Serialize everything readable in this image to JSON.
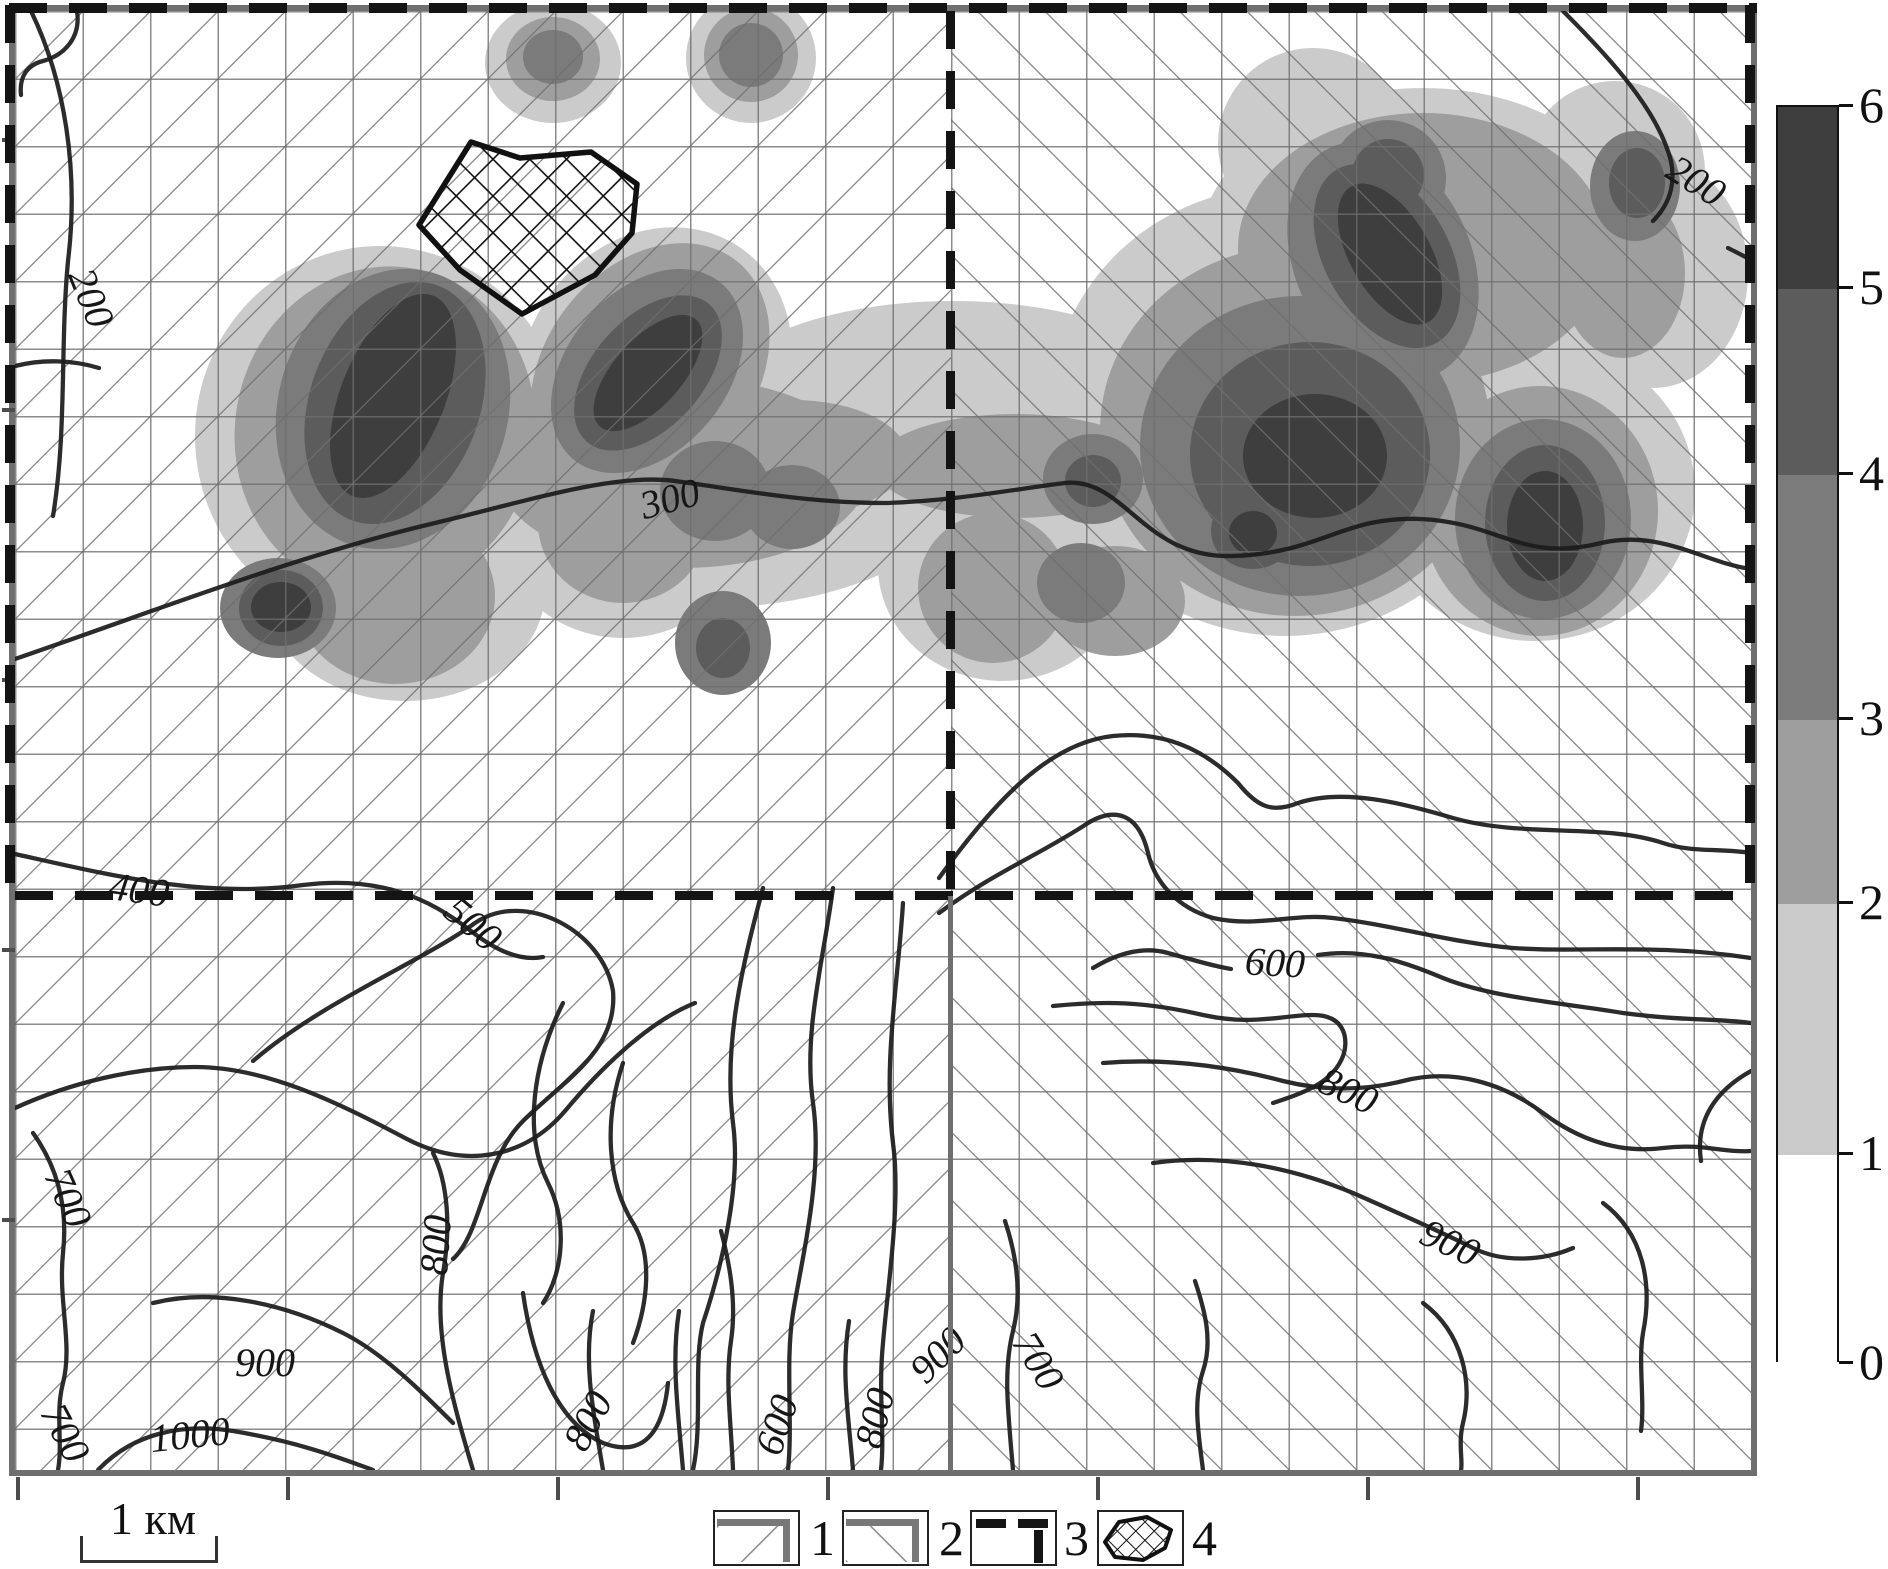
{
  "scalebar": {
    "label": "1 км"
  },
  "colorbar": {
    "labels": [
      "6",
      "5",
      "4",
      "3",
      "2",
      "1",
      "0"
    ],
    "boundaries_y": [
      105,
      287,
      473,
      718,
      902,
      1153,
      1362
    ],
    "segment_colors": [
      "#3e3e3e",
      "#5c5c5c",
      "#7b7b7b",
      "#9e9e9e",
      "#cbcbcb",
      "#ffffff"
    ],
    "x": 1776,
    "width": 63
  },
  "legend": {
    "items": [
      {
        "label": "1",
        "type": "hatch-forward"
      },
      {
        "label": "2",
        "type": "hatch-back"
      },
      {
        "label": "3",
        "type": "boundary-lines"
      },
      {
        "label": "4",
        "type": "crosshatch-polygon"
      }
    ],
    "box_xs": [
      713,
      842,
      970,
      1097
    ],
    "num_xs": [
      810,
      939,
      1064,
      1192
    ]
  },
  "map": {
    "x": 12,
    "y": 8,
    "width": 1736,
    "height": 1459,
    "grid_spacing": 67.5,
    "frame_color": "#6f6f6f",
    "dash_color": "#141414",
    "hatch_left_direction": "/",
    "hatch_right_direction": "\\",
    "divider_x": 936,
    "divider_y": 885,
    "bottom_ticks_x": [
      1,
      271,
      541,
      811,
      1081,
      1351,
      1621
    ],
    "left_ticks_y": [
      127,
      397,
      667,
      937,
      1207
    ]
  },
  "level_colors": {
    "1": "#cbcbcb",
    "2": "#9e9e9e",
    "3": "#7b7b7b",
    "4": "#5c5c5c",
    "5": "#3e3e3e"
  },
  "anomaly_blobs": [
    [
      365,
      425,
      185,
      190,
      0,
      1
    ],
    [
      640,
      360,
      130,
      150,
      35,
      1
    ],
    [
      688,
      472,
      260,
      125,
      0,
      1
    ],
    [
      938,
      400,
      250,
      110,
      0,
      1
    ],
    [
      988,
      555,
      125,
      115,
      0,
      1
    ],
    [
      1270,
      400,
      235,
      225,
      0,
      1
    ],
    [
      1408,
      242,
      225,
      165,
      0,
      1
    ],
    [
      1520,
      480,
      160,
      150,
      0,
      1
    ],
    [
      1638,
      262,
      95,
      115,
      0,
      1
    ],
    [
      1600,
      160,
      90,
      90,
      0,
      1
    ],
    [
      1298,
      132,
      95,
      95,
      0,
      1
    ],
    [
      538,
      52,
      68,
      60,
      0,
      1
    ],
    [
      736,
      47,
      65,
      65,
      0,
      1
    ],
    [
      608,
      512,
      125,
      115,
      0,
      1
    ],
    [
      390,
      580,
      140,
      110,
      0,
      1
    ],
    [
      370,
      420,
      150,
      165,
      10,
      2
    ],
    [
      635,
      360,
      105,
      140,
      38,
      2
    ],
    [
      668,
      462,
      185,
      95,
      0,
      2
    ],
    [
      778,
      447,
      115,
      58,
      0,
      2
    ],
    [
      1000,
      455,
      140,
      52,
      0,
      2
    ],
    [
      1280,
      420,
      195,
      185,
      0,
      2
    ],
    [
      1408,
      237,
      185,
      135,
      0,
      2
    ],
    [
      1525,
      500,
      118,
      125,
      0,
      2
    ],
    [
      1608,
      262,
      62,
      85,
      0,
      2
    ],
    [
      538,
      48,
      47,
      42,
      0,
      2
    ],
    [
      736,
      44,
      47,
      47,
      0,
      2
    ],
    [
      978,
      577,
      75,
      75,
      0,
      2
    ],
    [
      1100,
      590,
      70,
      55,
      0,
      2
    ],
    [
      608,
      512,
      85,
      80,
      0,
      2
    ],
    [
      380,
      585,
      100,
      88,
      0,
      2
    ],
    [
      378,
      398,
      115,
      142,
      16,
      3
    ],
    [
      632,
      360,
      80,
      115,
      40,
      3
    ],
    [
      700,
      480,
      55,
      50,
      0,
      3
    ],
    [
      777,
      496,
      48,
      42,
      0,
      3
    ],
    [
      1078,
      468,
      50,
      45,
      0,
      3
    ],
    [
      1066,
      572,
      44,
      40,
      0,
      3
    ],
    [
      1285,
      435,
      160,
      150,
      0,
      3
    ],
    [
      1368,
      250,
      88,
      125,
      -25,
      3
    ],
    [
      1528,
      508,
      88,
      100,
      0,
      3
    ],
    [
      1620,
      175,
      45,
      55,
      0,
      3
    ],
    [
      1373,
      167,
      58,
      58,
      0,
      3
    ],
    [
      538,
      46,
      30,
      27,
      0,
      3
    ],
    [
      736,
      44,
      32,
      32,
      0,
      3
    ],
    [
      708,
      632,
      48,
      52,
      0,
      3
    ],
    [
      263,
      597,
      58,
      50,
      0,
      3
    ],
    [
      1248,
      522,
      60,
      55,
      0,
      3
    ],
    [
      380,
      392,
      85,
      125,
      20,
      4
    ],
    [
      633,
      362,
      55,
      92,
      42,
      4
    ],
    [
      1295,
      443,
      120,
      112,
      0,
      4
    ],
    [
      1372,
      245,
      62,
      100,
      -30,
      4
    ],
    [
      1530,
      512,
      60,
      78,
      0,
      4
    ],
    [
      266,
      597,
      42,
      38,
      0,
      4
    ],
    [
      1373,
      164,
      36,
      36,
      0,
      4
    ],
    [
      708,
      637,
      27,
      30,
      0,
      4
    ],
    [
      1238,
      520,
      42,
      38,
      0,
      4
    ],
    [
      1078,
      470,
      28,
      26,
      0,
      4
    ],
    [
      1622,
      172,
      28,
      35,
      0,
      4
    ],
    [
      378,
      385,
      52,
      108,
      22,
      5
    ],
    [
      633,
      362,
      34,
      72,
      42,
      5
    ],
    [
      1300,
      445,
      72,
      62,
      0,
      5
    ],
    [
      1375,
      243,
      40,
      78,
      -30,
      5
    ],
    [
      266,
      596,
      30,
      25,
      0,
      5
    ],
    [
      1530,
      515,
      38,
      55,
      0,
      5
    ],
    [
      1238,
      522,
      24,
      22,
      0,
      5
    ]
  ],
  "crosshatch_polygon": {
    "points": "404,214 456,131 505,147 576,141 622,173 617,222 580,264 507,303 445,259"
  },
  "legend_polygon_points": "6,30 20,10 48,5 72,18 66,36 44,48 16,45",
  "contour_labels": [
    {
      "text": "200",
      "x": 76,
      "y": 287,
      "rot": 68
    },
    {
      "text": "200",
      "x": 1681,
      "y": 170,
      "rot": 32
    },
    {
      "text": "300",
      "x": 655,
      "y": 488,
      "rot": -15
    },
    {
      "text": "400",
      "x": 124,
      "y": 879,
      "rot": 8
    },
    {
      "text": "500",
      "x": 458,
      "y": 913,
      "rot": 40
    },
    {
      "text": "600",
      "x": 1260,
      "y": 952,
      "rot": 3
    },
    {
      "text": "800",
      "x": 1333,
      "y": 1080,
      "rot": 25
    },
    {
      "text": "900",
      "x": 1435,
      "y": 1232,
      "rot": 25
    },
    {
      "text": "700",
      "x": 53,
      "y": 1187,
      "rot": 66
    },
    {
      "text": "800",
      "x": 421,
      "y": 1234,
      "rot": -86
    },
    {
      "text": "900",
      "x": 250,
      "y": 1352,
      "rot": 0
    },
    {
      "text": "1000",
      "x": 175,
      "y": 1424,
      "rot": -6
    },
    {
      "text": "700",
      "x": 50,
      "y": 1422,
      "rot": 62
    },
    {
      "text": "800",
      "x": 573,
      "y": 1410,
      "rot": -62
    },
    {
      "text": "600",
      "x": 762,
      "y": 1414,
      "rot": -72
    },
    {
      "text": "800",
      "x": 860,
      "y": 1407,
      "rot": -76
    },
    {
      "text": "900",
      "x": 923,
      "y": 1344,
      "rot": -45
    },
    {
      "text": "700",
      "x": 1023,
      "y": 1350,
      "rot": 58
    }
  ],
  "contour_paths": [
    "M 16,0 C 50,70 64,160 53,250 C 45,335 52,420 38,505",
    "M 62,0 C 66,26 50,44 28,50 C 12,54 4,66 6,84",
    "M 0,355 C 28,348 58,349 84,357",
    "M 0,648 C 140,600 280,545 420,512 C 520,488 600,462 660,470 C 720,478 790,492 870,492 C 940,490 1000,478 1050,472 C 1110,466 1128,548 1218,545 C 1308,542 1326,505 1406,508 C 1486,512 1506,552 1586,532 C 1646,518 1690,552 1736,558",
    "M 0,843 C 90,863 188,888 288,874 C 368,864 418,890 456,920 C 484,942 508,950 528,946",
    "M 238,1050 C 308,990 408,950 460,912 C 510,878 588,920 598,980 C 603,1040 548,1070 508,1110 C 468,1150 468,1220 438,1248",
    "M 748,877 C 728,952 708,1032 718,1112 C 726,1172 708,1252 688,1312 C 678,1352 688,1412 678,1459",
    "M 818,877 C 808,952 788,1022 798,1092 C 808,1162 788,1242 778,1302 C 770,1352 778,1412 773,1459",
    "M 888,892 C 883,972 868,1052 878,1132 C 886,1192 873,1272 868,1332 C 863,1382 870,1422 866,1459",
    "M 0,1097 C 55,1072 120,1056 180,1056 C 250,1056 320,1090 390,1127 C 450,1159 510,1147 550,1100 C 580,1064 630,1012 680,992",
    "M 18,1122 C 43,1157 53,1197 48,1242 C 43,1292 58,1332 48,1372 C 40,1402 48,1432 43,1459",
    "M 138,1292 C 198,1277 268,1292 328,1322 C 368,1342 408,1382 438,1412",
    "M 83,1459 C 118,1422 168,1412 218,1420 C 278,1430 318,1444 358,1459",
    "M 458,1459 C 438,1392 418,1322 428,1262 C 436,1217 433,1172 418,1142",
    "M 548,992 C 518,1052 508,1122 533,1172 C 553,1212 548,1262 528,1292",
    "M 608,1052 C 588,1112 593,1172 618,1212 C 638,1244 633,1292 618,1332",
    "M 508,1282 C 518,1352 543,1412 588,1432 C 628,1447 648,1422 653,1372",
    "M 588,1459 C 578,1400 568,1350 578,1300",
    "M 668,1459 C 663,1400 656,1350 664,1300",
    "M 718,1459 C 716,1410 710,1370 716,1330 C 722,1290 714,1250 706,1220",
    "M 838,1459 C 833,1400 826,1360 834,1310",
    "M 924,867 C 978,792 1033,732 1098,725 C 1148,720 1188,737 1223,772 C 1243,797 1258,802 1283,792 C 1328,777 1388,792 1438,807 C 1508,827 1588,812 1648,832 C 1678,842 1706,837 1736,842",
    "M 924,902 C 978,862 1028,842 1073,812 C 1098,797 1123,800 1133,842 C 1140,872 1163,897 1198,907 C 1243,917 1278,902 1318,907 C 1378,914 1438,932 1498,937 C 1568,942 1638,932 1736,947",
    "M 1078,957 C 1103,942 1128,935 1153,942 C 1178,949 1198,955 1216,958",
    "M 1303,944 C 1348,937 1388,950 1428,967 C 1478,987 1548,992 1608,1002 C 1668,1010 1698,1007 1736,1012",
    "M 1038,995 C 1088,990 1128,990 1188,1004 C 1238,1015 1268,1004 1298,1004 C 1333,1004 1333,1032 1328,1045 C 1318,1072 1288,1082 1258,1092",
    "M 1088,1052 C 1148,1047 1208,1054 1268,1070 C 1308,1080 1348,1080 1388,1070 C 1438,1057 1488,1072 1528,1102 C 1568,1132 1608,1142 1648,1137 C 1688,1132 1708,1142 1736,1140",
    "M 1138,1152 C 1208,1142 1278,1157 1338,1182 C 1388,1204 1428,1222 1458,1237 C 1488,1252 1528,1250 1558,1237",
    "M 998,1459 C 993,1400 988,1360 998,1320 C 1008,1280 1000,1240 990,1210",
    "M 1188,1459 C 1183,1420 1178,1390 1188,1360 C 1198,1330 1190,1300 1180,1270",
    "M 1408,1292 C 1448,1322 1458,1372 1448,1412 C 1443,1432 1448,1450 1446,1459",
    "M 1588,1192 C 1628,1222 1638,1272 1628,1322 C 1623,1352 1630,1390 1626,1420",
    "M 1548,0 C 1598,50 1643,100 1656,150 C 1661,175 1653,195 1638,210",
    "M 1713,237 C 1721,241 1729,245 1736,249",
    "M 1736,1060 C 1700,1080 1680,1110 1686,1150"
  ]
}
